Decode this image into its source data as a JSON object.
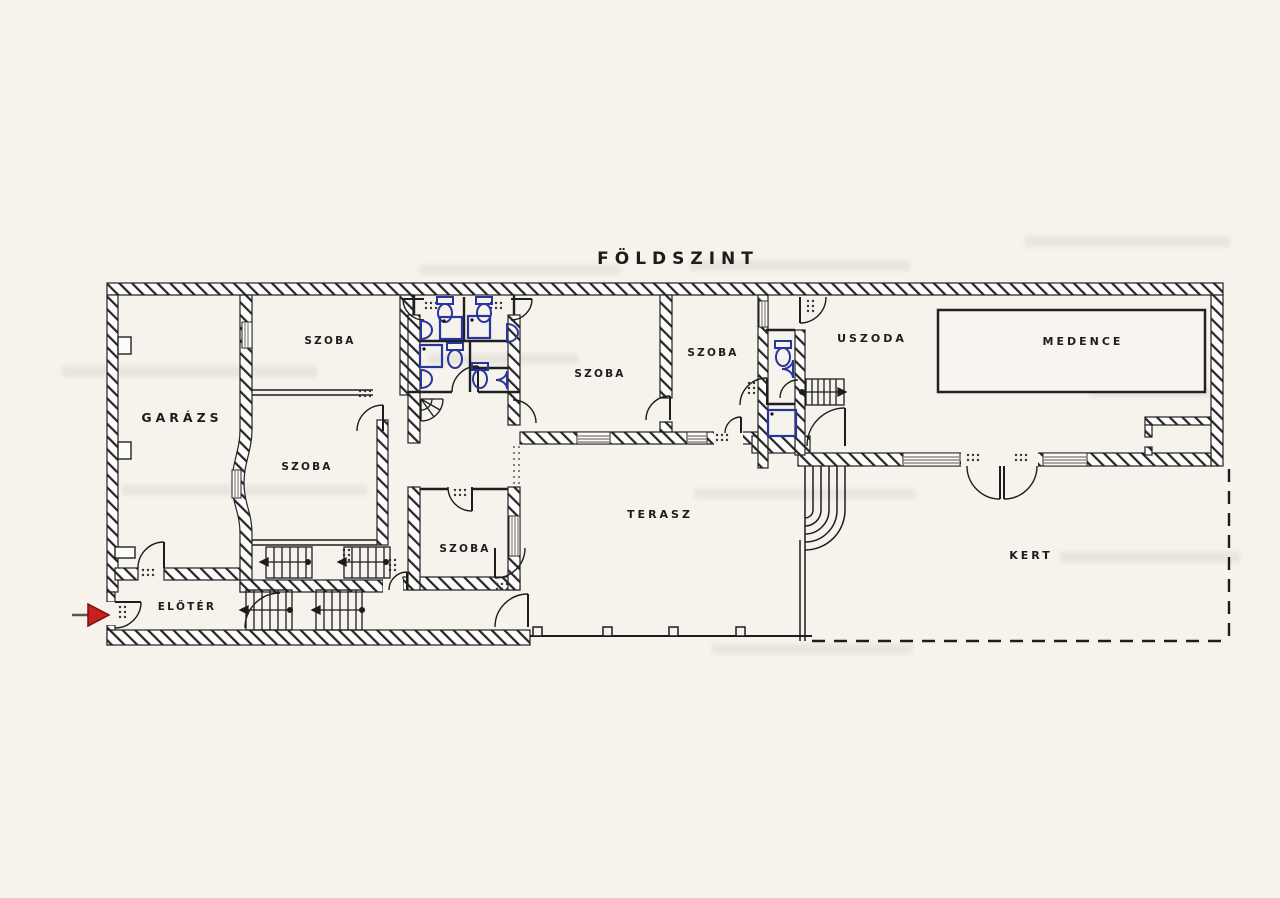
{
  "title": "FÖLDSZINT",
  "rooms": [
    {
      "id": "garazs",
      "label": "GARÁZS"
    },
    {
      "id": "szoba-1",
      "label": "SZOBA"
    },
    {
      "id": "szoba-2",
      "label": "SZOBA"
    },
    {
      "id": "szoba-3",
      "label": "SZOBA"
    },
    {
      "id": "szoba-4",
      "label": "SZOBA"
    },
    {
      "id": "szoba-5",
      "label": "SZOBA"
    },
    {
      "id": "uszoda",
      "label": "USZODA"
    },
    {
      "id": "medence",
      "label": "MEDENCE"
    },
    {
      "id": "terasz",
      "label": "TERASZ"
    },
    {
      "id": "kert",
      "label": "KERT"
    },
    {
      "id": "eloter",
      "label": "ELŐTÉR"
    }
  ],
  "symbols": {
    "entrance_arrow": "entrance-direction-arrow",
    "toilet": "wc-toilet-icon",
    "sink": "washbasin-icon",
    "shower": "shower-tray-icon",
    "stairs": "stair-flight-with-direction-arrow",
    "pool_basin": "swimming-pool-basin",
    "garden_boundary": "dashed-property-line"
  },
  "colors": {
    "paper": "#f6f2ec",
    "wall_fill": "#fdfcfa",
    "ink": "#1d1d1d",
    "fixture_blue": "#27359c",
    "arrow_red": "#c81f1f",
    "window_gray": "#8e8c86"
  }
}
